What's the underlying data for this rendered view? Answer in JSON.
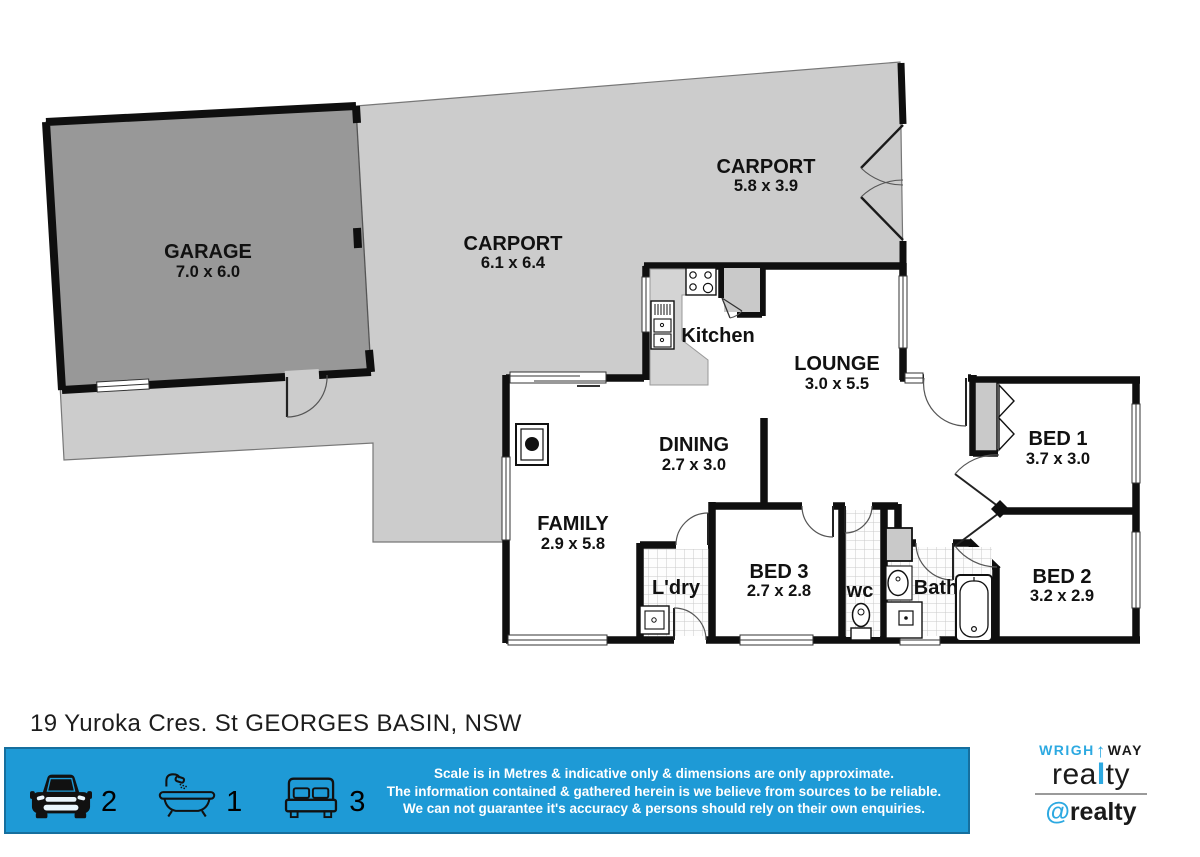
{
  "title": "19 Yuroka Cres. St GEORGES BASIN, NSW",
  "rooms": {
    "garage": {
      "name": "GARAGE",
      "dims": "7.0 x 6.0"
    },
    "carport_main": {
      "name": "CARPORT",
      "dims": "6.1 x 6.4"
    },
    "carport_rear": {
      "name": "CARPORT",
      "dims": "5.8 x 3.9"
    },
    "kitchen": {
      "name": "Kitchen"
    },
    "lounge": {
      "name": "LOUNGE",
      "dims": "3.0 x 5.5"
    },
    "dining": {
      "name": "DINING",
      "dims": "2.7 x 3.0"
    },
    "family": {
      "name": "FAMILY",
      "dims": "2.9 x 5.8"
    },
    "laundry": {
      "name": "L'dry"
    },
    "bed1": {
      "name": "BED 1",
      "dims": "3.7 x 3.0"
    },
    "bed2": {
      "name": "BED 2",
      "dims": "3.2 x 2.9"
    },
    "bed3": {
      "name": "BED 3",
      "dims": "2.7 x 2.8"
    },
    "wc": {
      "name": "wc"
    },
    "bath": {
      "name": "Bath"
    }
  },
  "footer": {
    "features": {
      "cars": "2",
      "baths": "1",
      "beds": "3"
    },
    "disclaimer": [
      "Scale is in Metres & indicative only & dimensions are only approximate.",
      "The information contained & gathered herein is we believe from sources to be reliable.",
      "We can not guarantee it's accuracy & persons should rely on their own enquiries."
    ]
  },
  "branding": {
    "line1_left": "WRIGH",
    "up_arrow": "↑",
    "line1_right": "WAY",
    "realty_pre": "rea",
    "realty_mid": "l",
    "realty_post": "ty",
    "at": "@",
    "at_name": "realty"
  },
  "colors": {
    "banner_blue": "#1e9ad6",
    "brand_blue": "#2da9e1",
    "garage_fill": "#989898",
    "carport_fill": "#cccccc",
    "wall": "#0f0f0f"
  }
}
